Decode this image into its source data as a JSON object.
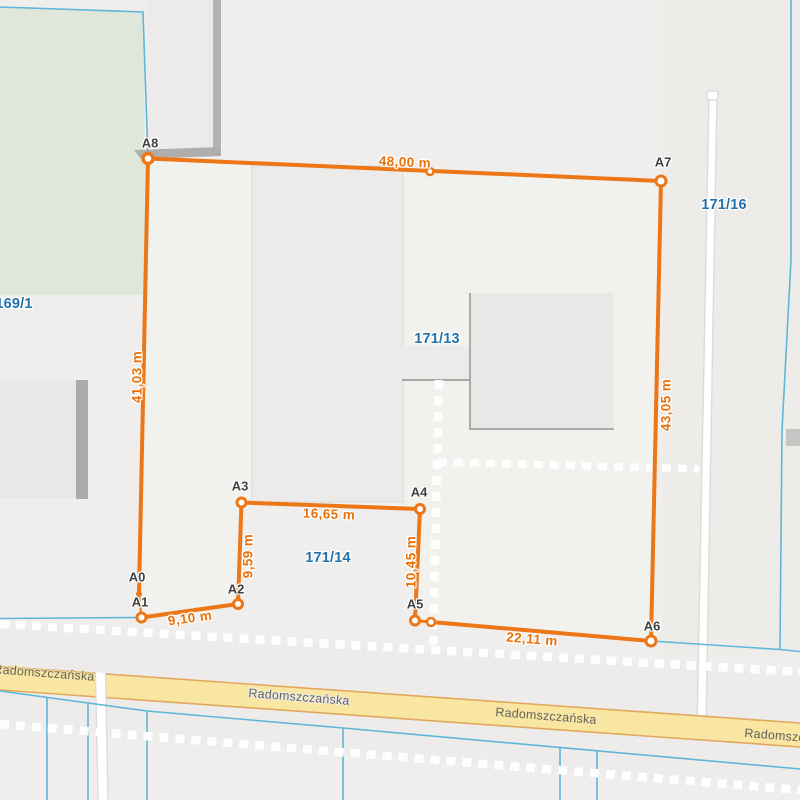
{
  "map": {
    "street": {
      "name": "Radomszczańska"
    },
    "parcels": [
      {
        "id": "169/1"
      },
      {
        "id": "171/13"
      },
      {
        "id": "171/14"
      },
      {
        "id": "171/16"
      }
    ],
    "measurement": {
      "vertices": [
        {
          "id": "A0"
        },
        {
          "id": "A1"
        },
        {
          "id": "A2"
        },
        {
          "id": "A3"
        },
        {
          "id": "A4"
        },
        {
          "id": "A5"
        },
        {
          "id": "A6"
        },
        {
          "id": "A7"
        },
        {
          "id": "A8"
        }
      ],
      "segments": [
        {
          "from": "A1",
          "to": "A2",
          "length_label": "9,10 m"
        },
        {
          "from": "A2",
          "to": "A3",
          "length_label": "9,59 m"
        },
        {
          "from": "A3",
          "to": "A4",
          "length_label": "16,65 m"
        },
        {
          "from": "A4",
          "to": "A5",
          "length_label": "10,45 m"
        },
        {
          "from": "A5",
          "to": "A6",
          "length_label": "22,11 m"
        },
        {
          "from": "A6",
          "to": "A7",
          "length_label": "43,05 m"
        },
        {
          "from": "A7",
          "to": "A8",
          "length_label": "48,00 m"
        },
        {
          "from": "A8",
          "to": "A0",
          "length_label": "41,03 m"
        }
      ]
    },
    "colors": {
      "measure_accent": "#ED7617",
      "parcel_label_blue": "#2470A8",
      "boundary_cyan": "#5FB6D9",
      "road_fill": "#F9E6A2",
      "road_border": "#E2A85F",
      "cadastral_dash": "#FFFFFF",
      "green_area": "#DFE7DA"
    }
  }
}
